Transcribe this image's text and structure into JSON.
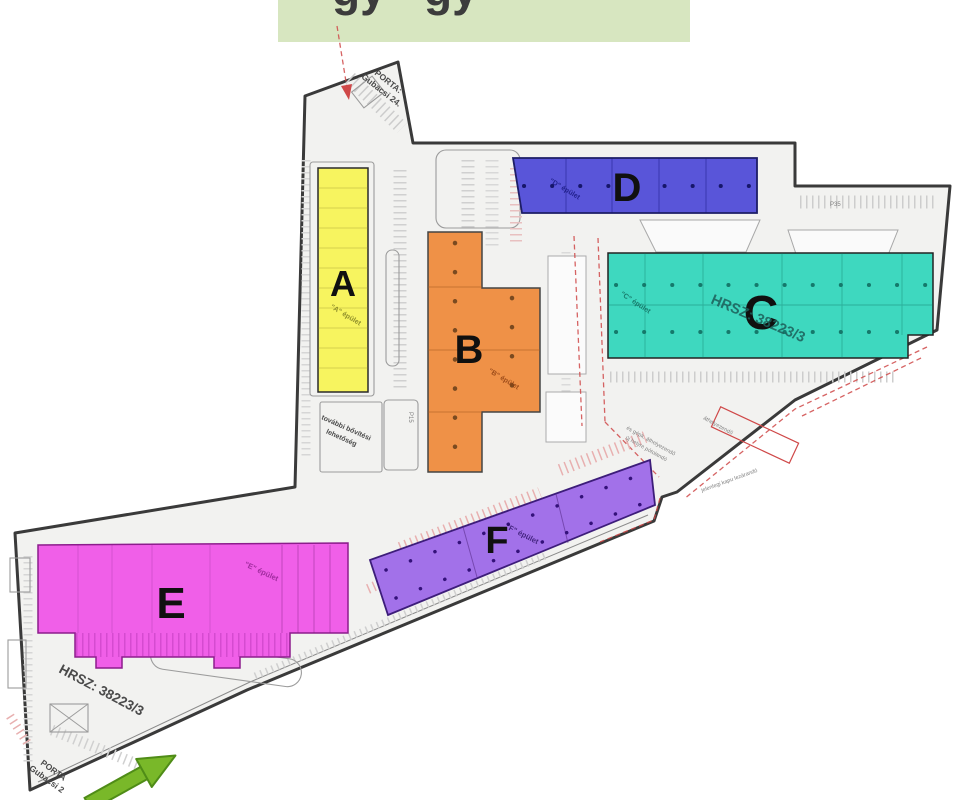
{
  "header": {
    "bar_color": "#d7e6c0",
    "clipped_fragments": [
      "gy",
      "gy"
    ]
  },
  "colors": {
    "site_fill": "#f2f2f0",
    "boundary": "#3a3a3a",
    "fire_route_red": "#cf4848",
    "entrance_arrow_green": "#79b829"
  },
  "buildings": {
    "a": {
      "letter": "A",
      "name": "\"A\" épület",
      "fill": "#f7f45f"
    },
    "b": {
      "letter": "B",
      "name": "\"B\" épület",
      "fill": "#ef9147"
    },
    "c": {
      "letter": "C",
      "name": "\"C\" épület",
      "fill": "#3ed8bf"
    },
    "d": {
      "letter": "D",
      "name": "\"D\" épület",
      "fill": "#5955d9"
    },
    "e": {
      "letter": "E",
      "name": "\"E\" épület",
      "fill": "#f05fe8"
    },
    "f": {
      "letter": "F",
      "name": "\"F\" épület",
      "fill": "#a271e9"
    }
  },
  "annotations": {
    "porta_top": [
      "PORTA:",
      "Gubacsi 24."
    ],
    "porta_bottom": [
      "PORTA",
      "Gubacsi 2"
    ],
    "hrsz": "HRSZ: 38223/3",
    "expansion": [
      "további bővítési",
      "lehetőség"
    ],
    "p35": "P35",
    "p15": "P15",
    "gate_note": "jelenlegi kapu lezárandó",
    "relocate_note": [
      "és gépk. áthelyezendő",
      "új helyre pótolandó"
    ],
    "relocate_note2": "áthelyezendő"
  }
}
